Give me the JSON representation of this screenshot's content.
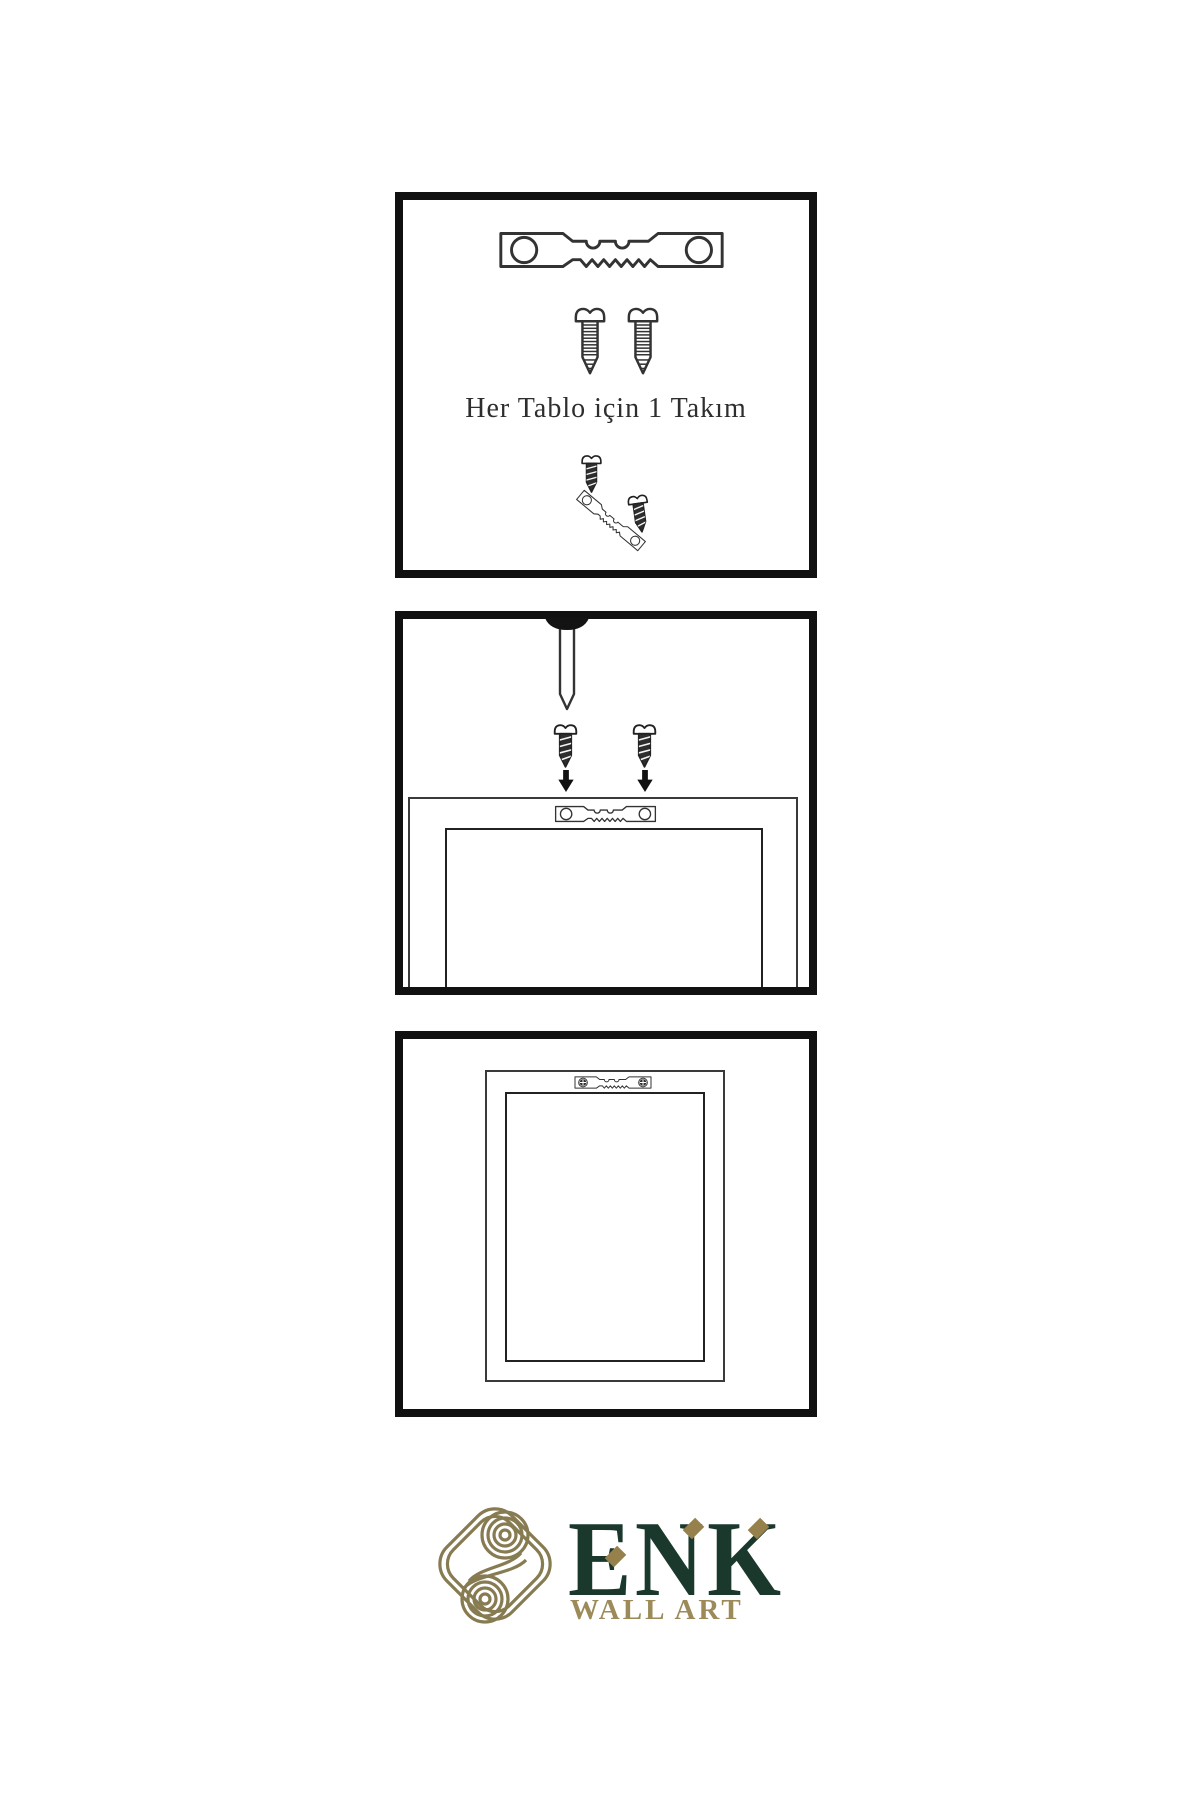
{
  "page": {
    "background": "#ffffff",
    "type": "wall-art hanging instruction sheet"
  },
  "steps": [
    {
      "id": 1,
      "caption": "Her Tablo için 1 Takım",
      "items": [
        "sawtooth-hanger",
        "screw",
        "screw",
        "screw-driven-into-tilted-hanger"
      ]
    },
    {
      "id": 2,
      "caption": "",
      "items": [
        "nail-in-wall",
        "screw",
        "screw",
        "down-arrow",
        "down-arrow",
        "frame-back",
        "sawtooth-hanger-on-frame"
      ]
    },
    {
      "id": 3,
      "caption": "",
      "items": [
        "hung-frame-back",
        "sawtooth-hanger-fastened-with-screws"
      ]
    }
  ],
  "logo": {
    "brand": "ENK",
    "subtitle": "WALL ART",
    "mark": "interlocking-knot"
  },
  "colors": {
    "panel_border": "#111111",
    "drawing_line": "#333333",
    "screw_fill": "#2e2e2e",
    "knot_gold": "#877b51",
    "brand_green": "#1b382c",
    "subtitle_gold": "#9c8a59",
    "diamond_gold": "#96814d"
  }
}
